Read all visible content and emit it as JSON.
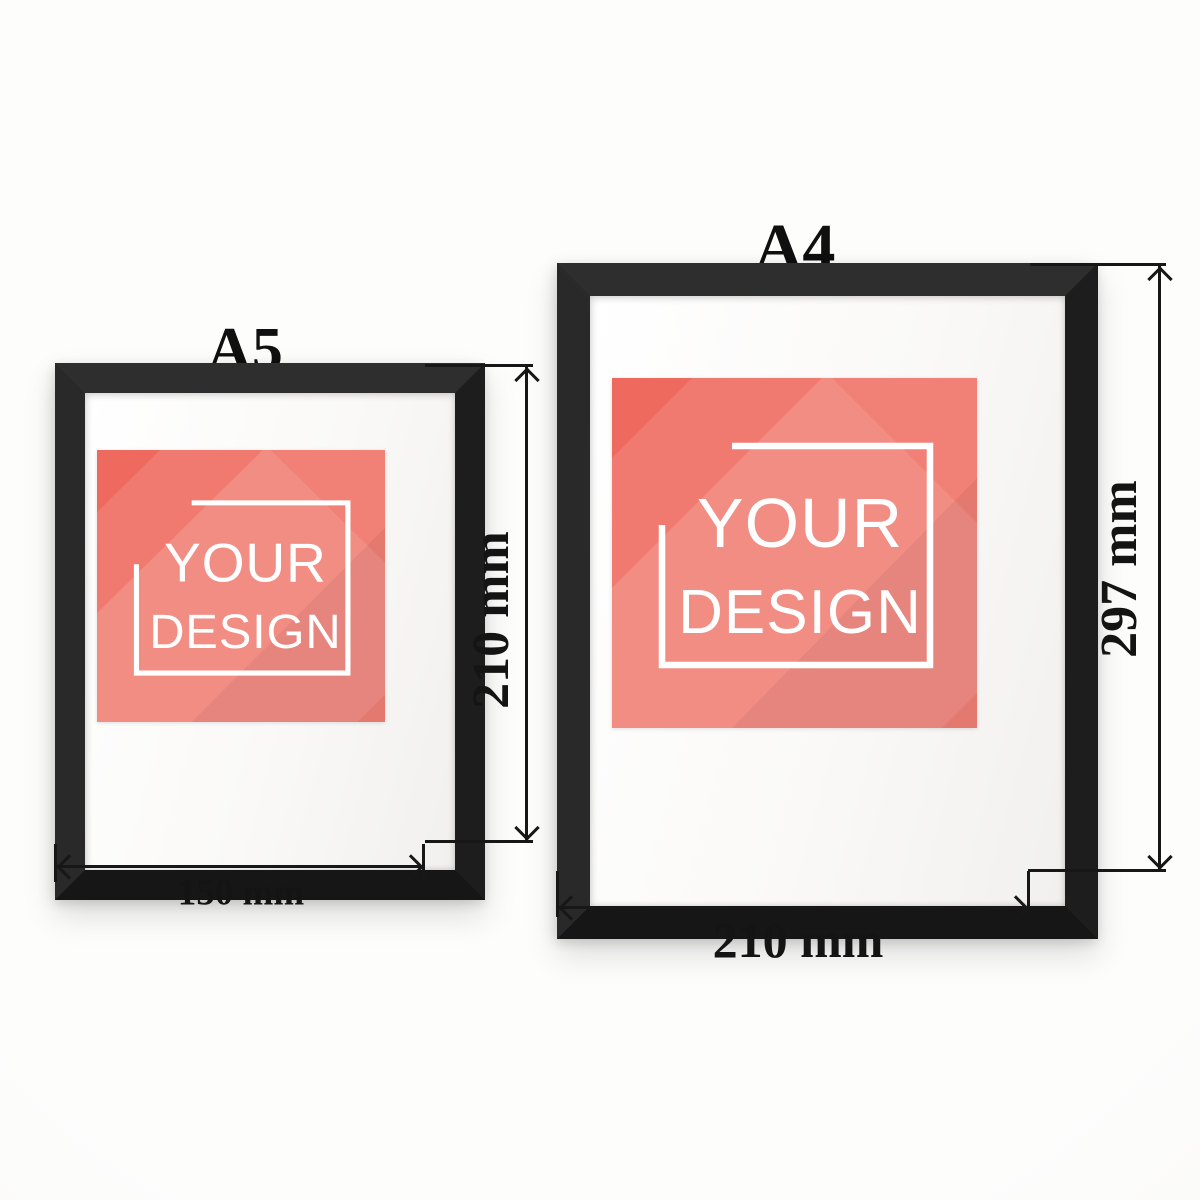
{
  "canvas": {
    "width": 1200,
    "height": 1200,
    "background": "#fbfbfa"
  },
  "colors": {
    "ink": "#171717",
    "frame_black": "#262627",
    "mat_white": "#fdfdfc",
    "design_red": "#ef6a5e",
    "design_text_white": "#ffffff"
  },
  "frames": [
    {
      "id": "a5",
      "title": "A5",
      "width_label": "150 mm",
      "height_label": "210 mm",
      "placeholder": {
        "line1": "YOUR",
        "line2": "DESIGN"
      }
    },
    {
      "id": "a4",
      "title": "A4",
      "width_label": "210 mm",
      "height_label": "297 mm",
      "placeholder": {
        "line1": "YOUR",
        "line2": "DESIGN"
      }
    }
  ]
}
